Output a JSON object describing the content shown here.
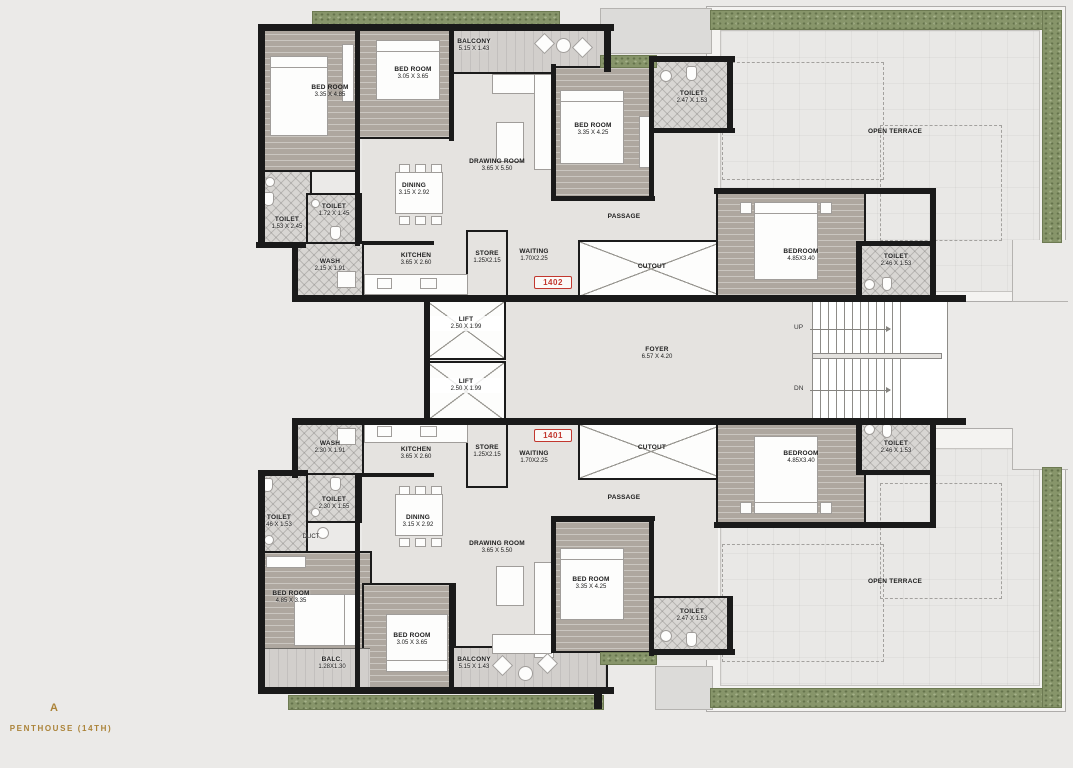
{
  "title": {
    "block": "A",
    "floor": "PENTHOUSE (14TH)"
  },
  "badges": {
    "top": "1402",
    "bottom": "1401"
  },
  "colors": {
    "accent_gold": "#ab8338",
    "badge_red": "#c2372e",
    "wall": "#1a1a1a",
    "planter_green": "#87956a",
    "wood_floor": "#aea79f",
    "marble": "#e5e3e0"
  },
  "core": {
    "lift1": {
      "name": "LIFT",
      "dims": "2.50 X 1.99"
    },
    "lift2": {
      "name": "LIFT",
      "dims": "2.50 X 1.99"
    },
    "foyer": {
      "name": "FOYER",
      "dims": "6.57 X 4.20"
    },
    "up": "UP",
    "dn": "DN"
  },
  "terrace": {
    "top": "OPEN TERRACE",
    "bottom": "OPEN TERRACE"
  },
  "unit_1402": {
    "bed1": {
      "name": "BED ROOM",
      "dims": "3.35 X 4.85"
    },
    "bed2": {
      "name": "BED ROOM",
      "dims": "3.05 X 3.65"
    },
    "balcony": {
      "name": "BALCONY",
      "dims": "5.15 X 1.43"
    },
    "bed3": {
      "name": "BED ROOM",
      "dims": "3.35 X 4.25"
    },
    "drawing": {
      "name": "DRAWING ROOM",
      "dims": "3.65 X 5.50"
    },
    "dining": {
      "name": "DINING",
      "dims": "3.15 X 2.92"
    },
    "toilet1": {
      "name": "TOILET",
      "dims": "1.53 X 2.45"
    },
    "toilet2": {
      "name": "TOILET",
      "dims": "1.72 X 1.45"
    },
    "wash": {
      "name": "WASH",
      "dims": "2.15 X 1.91"
    },
    "kitchen": {
      "name": "KITCHEN",
      "dims": "3.65 X 2.60"
    },
    "store": {
      "name": "STORE",
      "dims": "1.25X2.15"
    },
    "waiting": {
      "name": "WAITING",
      "dims": "1.70X2.25"
    },
    "passage": {
      "name": "PASSAGE"
    },
    "cutout": {
      "name": "CUTOUT"
    },
    "toilet3": {
      "name": "TOILET",
      "dims": "2.47 X 1.53"
    },
    "bedroom4": {
      "name": "BEDROOM",
      "dims": "4.85X3.40"
    },
    "toilet4": {
      "name": "TOILET",
      "dims": "2.46 X 1.53"
    }
  },
  "unit_1401": {
    "wash": {
      "name": "WASH",
      "dims": "2.30 X 1.91"
    },
    "kitchen": {
      "name": "KITCHEN",
      "dims": "3.65 X 2.60"
    },
    "store": {
      "name": "STORE",
      "dims": "1.25X2.15"
    },
    "waiting": {
      "name": "WAITING",
      "dims": "1.70X2.25"
    },
    "toilet1": {
      "name": "TOILET",
      "dims": "2.30 X 1.55"
    },
    "toilet2": {
      "name": "TOILET",
      "dims": "46 X 1.53"
    },
    "duct": {
      "name": "DUCT"
    },
    "dining": {
      "name": "DINING",
      "dims": "3.15 X 2.92"
    },
    "drawing": {
      "name": "DRAWING ROOM",
      "dims": "3.65 X 5.50"
    },
    "bed1": {
      "name": "BED ROOM",
      "dims": "4.85 X 3.35"
    },
    "balc": {
      "name": "BALC.",
      "dims": "1.28X1.30"
    },
    "bed2": {
      "name": "BED ROOM",
      "dims": "3.05 X 3.65"
    },
    "balcony": {
      "name": "BALCONY",
      "dims": "5.15 X 1.43"
    },
    "bed3": {
      "name": "BED ROOM",
      "dims": "3.35 X 4.25"
    },
    "toilet3": {
      "name": "TOILET",
      "dims": "2.47 X 1.53"
    },
    "passage": {
      "name": "PASSAGE"
    },
    "cutout": {
      "name": "CUTOUT"
    },
    "bedroom4": {
      "name": "BEDROOM",
      "dims": "4.85X3.40"
    },
    "toilet4": {
      "name": "TOILET",
      "dims": "2.46 X 1.53"
    }
  }
}
